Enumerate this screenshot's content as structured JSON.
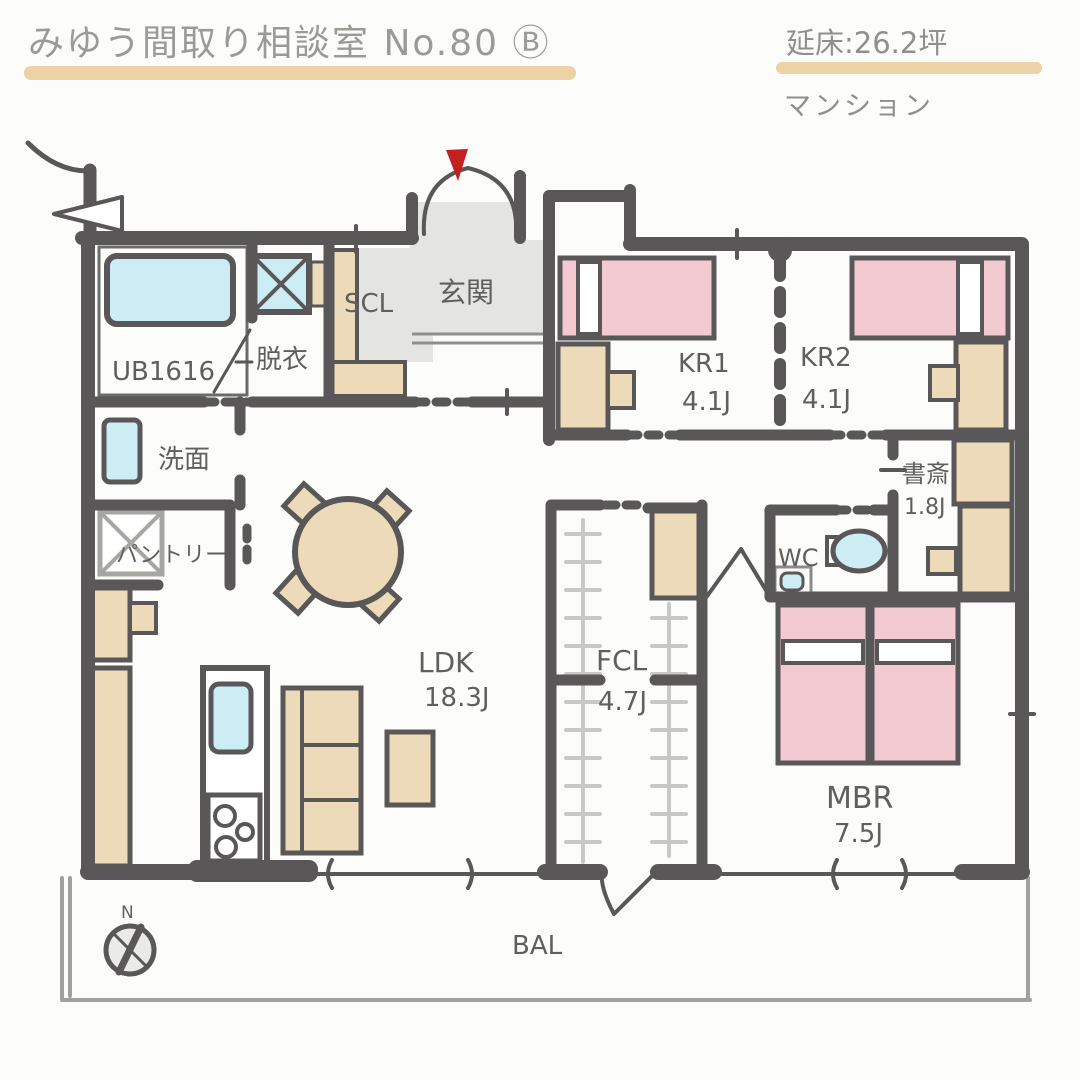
{
  "header": {
    "title": "みゆう間取り相談室 No.80 Ⓑ",
    "floor_area_label": "延床:26.2坪",
    "building_type": "マンション"
  },
  "rooms": {
    "entrance": {
      "label": "玄関"
    },
    "scl": {
      "label": "SCL"
    },
    "bath": {
      "label": "UB1616"
    },
    "dressing": {
      "label": "脱衣"
    },
    "washroom": {
      "label": "洗面"
    },
    "pantry": {
      "label": "パントリー"
    },
    "ldk": {
      "label": "LDK",
      "size": "18.3J"
    },
    "fcl": {
      "label": "FCL",
      "size": "4.7J"
    },
    "kr1": {
      "label": "KR1",
      "size": "4.1J"
    },
    "kr2": {
      "label": "KR2",
      "size": "4.1J"
    },
    "study": {
      "label": "書斎",
      "size": "1.8J"
    },
    "wc": {
      "label": "WC"
    },
    "mbr": {
      "label": "MBR",
      "size": "7.5J"
    },
    "balcony": {
      "label": "BAL"
    }
  },
  "compass": {
    "north": "N"
  },
  "colors": {
    "wall": "#595757",
    "ink": "#5f5f5c",
    "title-ink": "#9b9b96",
    "underline": "#ecd2a4",
    "tan": "#ecdab8",
    "pink": "#f3c9d2",
    "blue": "#cdedf4",
    "grayfloor": "#e4e4e3",
    "red": "#c32020"
  }
}
